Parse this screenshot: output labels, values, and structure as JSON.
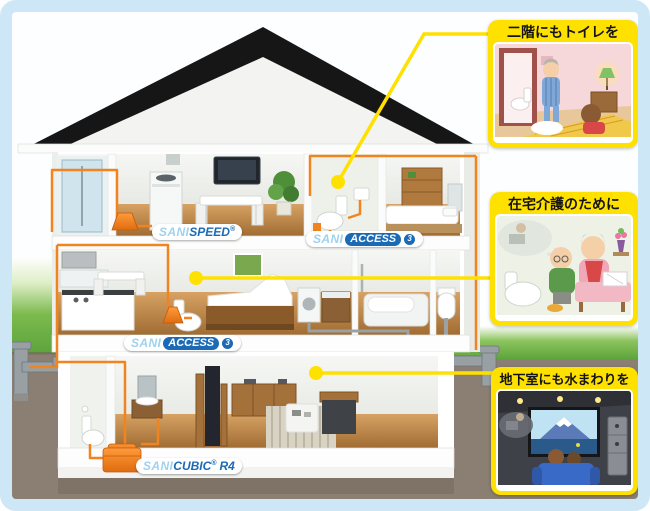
{
  "products": {
    "sanispeed": {
      "prefix": "SANI",
      "name": "SPEED",
      "reg": "®"
    },
    "saniaccess_2f": {
      "prefix": "SANI",
      "name": "ACCESS",
      "number": "3"
    },
    "saniaccess_1f": {
      "prefix": "SANI",
      "name": "ACCESS",
      "number": "3"
    },
    "sanicubic": {
      "prefix": "SANI",
      "name": "CUBIC",
      "reg": "®",
      "model": "R4"
    }
  },
  "callouts": [
    {
      "title": "二階にもトイレを"
    },
    {
      "title": "在宅介護のために"
    },
    {
      "title": "地下室にも水まわりを"
    }
  ],
  "colors": {
    "accent_yellow": "#ffe100",
    "pipe_orange": "#ef8420",
    "brand_blue": "#1a6ab5",
    "brand_light_blue": "#9ed2ee",
    "frame_blue": "#cde7f7",
    "grass_green": "#6cb23f",
    "underground_brown": "#8b7e72",
    "roof_black": "#161616"
  }
}
